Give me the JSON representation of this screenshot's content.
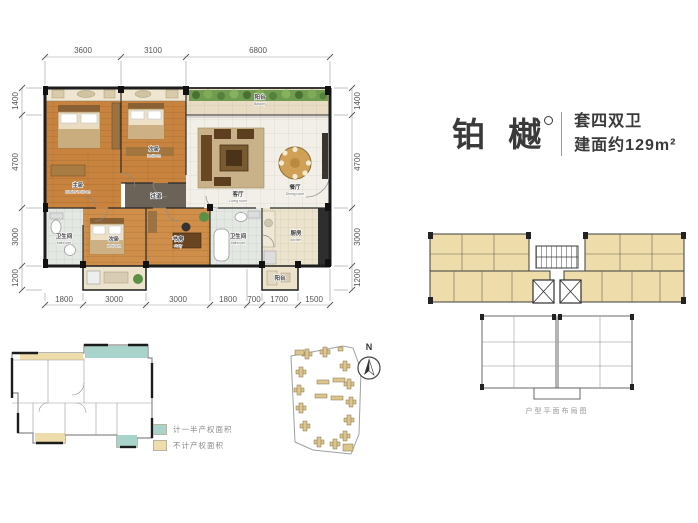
{
  "header": {
    "name": "铂 樾",
    "spec": "套四双卫",
    "area": "建面约129m²"
  },
  "dims": {
    "top": [
      "3600",
      "3100",
      "6800"
    ],
    "left": [
      "1400",
      "4700",
      "3000",
      "1200"
    ],
    "right": [
      "1400",
      "4700",
      "3000",
      "1200"
    ],
    "bottom": [
      "1800",
      "3000",
      "3000",
      "1800",
      "700",
      "1700",
      "1500"
    ]
  },
  "rooms": {
    "master": {
      "label": "主卧",
      "sub": "Master bedroom"
    },
    "bed2": {
      "label": "次卧",
      "sub": "bedroom"
    },
    "living": {
      "label": "客厅",
      "sub": "Living room"
    },
    "dining": {
      "label": "餐厅",
      "sub": "Dining room"
    },
    "balcony": {
      "label": "阳台",
      "sub": "Balcony"
    },
    "bath1": {
      "label": "卫生间",
      "sub": "bathroom"
    },
    "bed3": {
      "label": "次卧",
      "sub": "bedroom"
    },
    "study": {
      "label": "书房",
      "sub": "study"
    },
    "bath2": {
      "label": "卫生间",
      "sub": "bathroom"
    },
    "kitchen": {
      "label": "厨房",
      "sub": "kitchen"
    },
    "balcony2": {
      "label": "阳台",
      "sub": "balcony"
    },
    "hallway": {
      "label": "过道",
      "sub": ""
    }
  },
  "legend": {
    "items": [
      {
        "label": "计一半产权面积",
        "color": "#a9d4cb"
      },
      {
        "label": "不计产权面积",
        "color": "#eedcab"
      }
    ]
  },
  "key_plan": {
    "caption": "户型平面布局图"
  },
  "compass": {
    "label": "N"
  },
  "colors": {
    "wood": "#c8833f",
    "wood2": "#cf8f4a",
    "marble": "#f2efe9",
    "tile": "#e4e8e3",
    "cream": "#ece3cd",
    "balcony_floor": "#e8ddc4",
    "hall": "#6b6258",
    "tan": "#eedcab",
    "teal": "#a9d4cb",
    "wall": "#1d1d1d",
    "green": "#6f9c50"
  }
}
